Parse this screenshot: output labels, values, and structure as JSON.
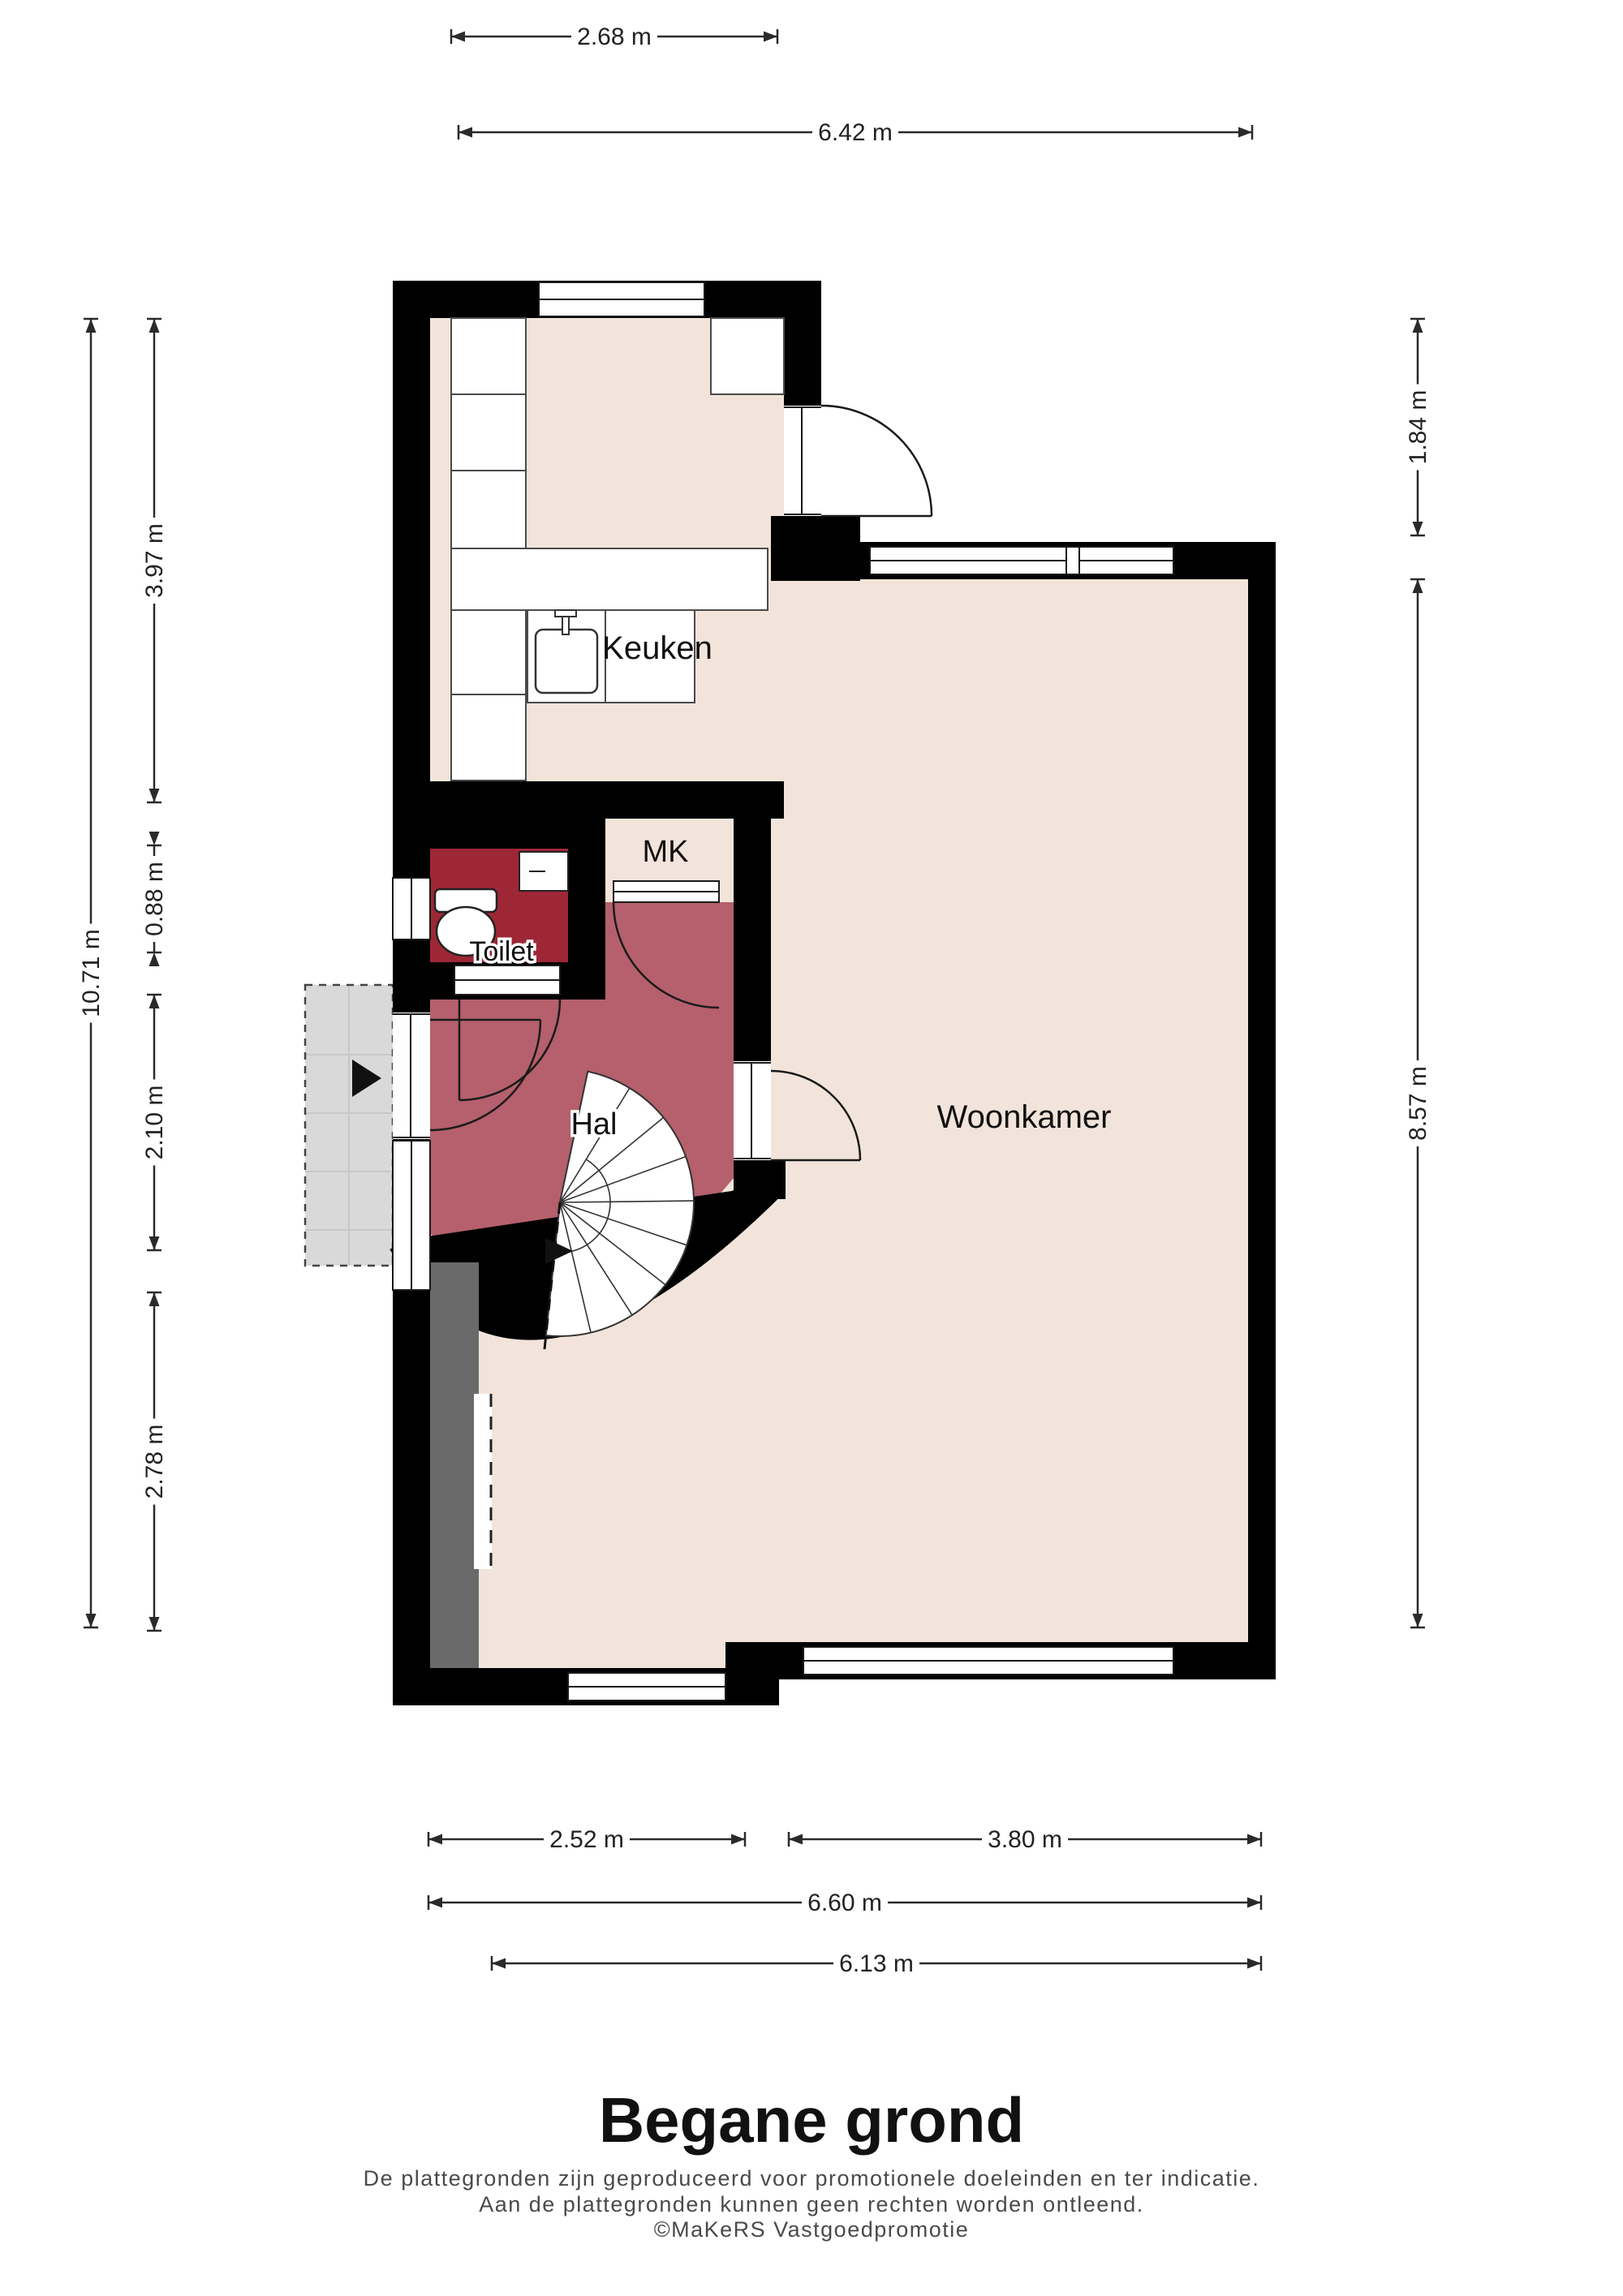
{
  "title": {
    "heading": "Begane grond"
  },
  "footer": {
    "line1": "De plattegronden zijn geproduceerd voor promotionele doeleinden en ter indicatie.",
    "line2": "Aan de plattegronden kunnen geen rechten worden ontleend.",
    "line3": "©MaKeRS Vastgoedpromotie"
  },
  "rooms": {
    "keuken": {
      "label": "Keuken"
    },
    "woonkamer": {
      "label": "Woonkamer"
    },
    "hal": {
      "label": "Hal"
    },
    "toilet": {
      "label": "Toilet"
    },
    "mk": {
      "label": "MK"
    }
  },
  "dims": [
    {
      "label": "2.68 m"
    },
    {
      "label": "6.42 m"
    },
    {
      "label": "10.71 m"
    },
    {
      "label": "3.97 m"
    },
    {
      "label": "0.88 m"
    },
    {
      "label": "2.10 m"
    },
    {
      "label": "2.78 m"
    },
    {
      "label": "1.84 m"
    },
    {
      "label": "8.57 m"
    },
    {
      "label": "2.52 m"
    },
    {
      "label": "3.80 m"
    },
    {
      "label": "6.60 m"
    },
    {
      "label": "6.13 m"
    }
  ],
  "icons": {
    "entrance-arrow": "filled-right-triangle",
    "stairs-direction-arrow": "filled-right-triangle"
  },
  "colors": {
    "wall": "#000000",
    "floor": "#f2e4da",
    "hal": "#b5606c",
    "toilet": "#9e2736",
    "porch": "#d9d9d9",
    "darkwall": "#6a6a6a",
    "dimcolor": "#222222",
    "footer": "#4a4a4a"
  }
}
